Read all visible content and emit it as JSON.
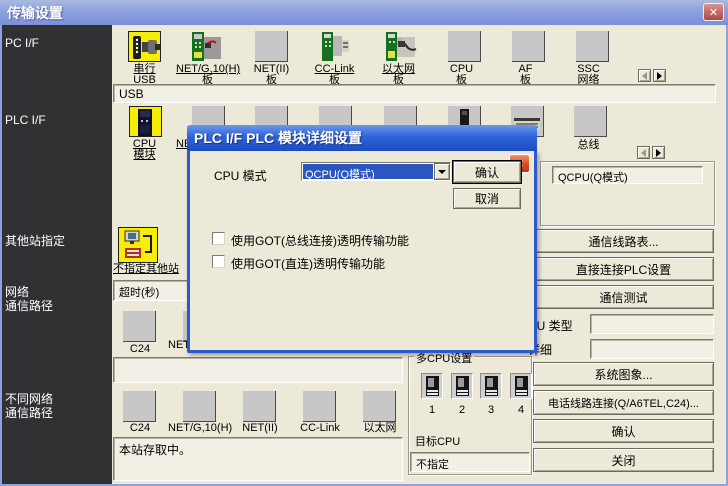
{
  "window": {
    "title": "传输设置",
    "close_glyph": "✕"
  },
  "sidebar": {
    "items": [
      {
        "label": "PC I/F"
      },
      {
        "label": "PLC I/F"
      },
      {
        "label": "其他站指定"
      },
      {
        "label": "网络\n通信路径"
      },
      {
        "label": "不同网络\n通信路径"
      }
    ]
  },
  "pc_if": {
    "icons": [
      {
        "label": "串行\nUSB"
      },
      {
        "label": "NET/G,10(H)\n板"
      },
      {
        "label": "NET(II)\n板"
      },
      {
        "label": "CC-Link\n板"
      },
      {
        "label": "以太网\n板"
      },
      {
        "label": "CPU\n板"
      },
      {
        "label": "AF\n板"
      },
      {
        "label": "SSC\n网络"
      }
    ],
    "value": "USB"
  },
  "plc_if": {
    "icons": [
      {
        "label": "CPU\n模块"
      },
      {
        "label": "NET/G,10(H)\n板"
      },
      {
        "label": ""
      },
      {
        "label": ""
      },
      {
        "label": ""
      },
      {
        "label": ""
      },
      {
        "label": ""
      },
      {
        "label": "总线"
      }
    ],
    "mode_value": "QCPU(Q模式)"
  },
  "other_station": {
    "icon_label": "不指定其他站",
    "timeout_text": "超时(秒)"
  },
  "network_route": {
    "icons": [
      {
        "label": "C24"
      },
      {
        "label": "NET/G,10(H)"
      }
    ]
  },
  "diff_network_route": {
    "icons": [
      {
        "label": "C24"
      },
      {
        "label": "NET/G,10(H)"
      },
      {
        "label": "NET(II)"
      },
      {
        "label": "CC-Link"
      },
      {
        "label": "以太网"
      }
    ],
    "status_text": "本站存取中。"
  },
  "right_panel": {
    "buttons_top": [
      {
        "label": "通信线路表..."
      },
      {
        "label": "直接连接PLC设置"
      },
      {
        "label": "通信测试"
      }
    ],
    "cpu_type_label": "CPU 类型",
    "cpu_type_value": "",
    "detail_label": "详细",
    "detail_value": "",
    "buttons_bottom": [
      {
        "label": "系统图象..."
      },
      {
        "label": "电话线路连接(Q/A6TEL,C24)..."
      },
      {
        "label": "确认"
      },
      {
        "label": "关闭"
      }
    ]
  },
  "multi_cpu": {
    "title": "多CPU设置",
    "units": [
      {
        "label": "1"
      },
      {
        "label": "2"
      },
      {
        "label": "3"
      },
      {
        "label": "4"
      }
    ],
    "target_label": "目标CPU",
    "target_value": "不指定"
  },
  "dialog": {
    "title": "PLC I/F PLC 模块详细设置",
    "close_glyph": "✕",
    "cpu_mode_label": "CPU 模式",
    "cpu_mode_value": "QCPU(Q模式)",
    "ok_label": "确认",
    "cancel_label": "取消",
    "checkbox1_label": "使用GOT(总线连接)透明传输功能",
    "checkbox2_label": "使用GOT(直连)透明传输功能"
  },
  "colors": {
    "titlebar_inactive": "#8ea2e0",
    "titlebar_active": "#2f64da",
    "sidebar_bg": "#2f3133",
    "face": "#ece9d8",
    "selection_blue": "#2b56c0",
    "selected_icon_yellow": "#f6ee05"
  }
}
